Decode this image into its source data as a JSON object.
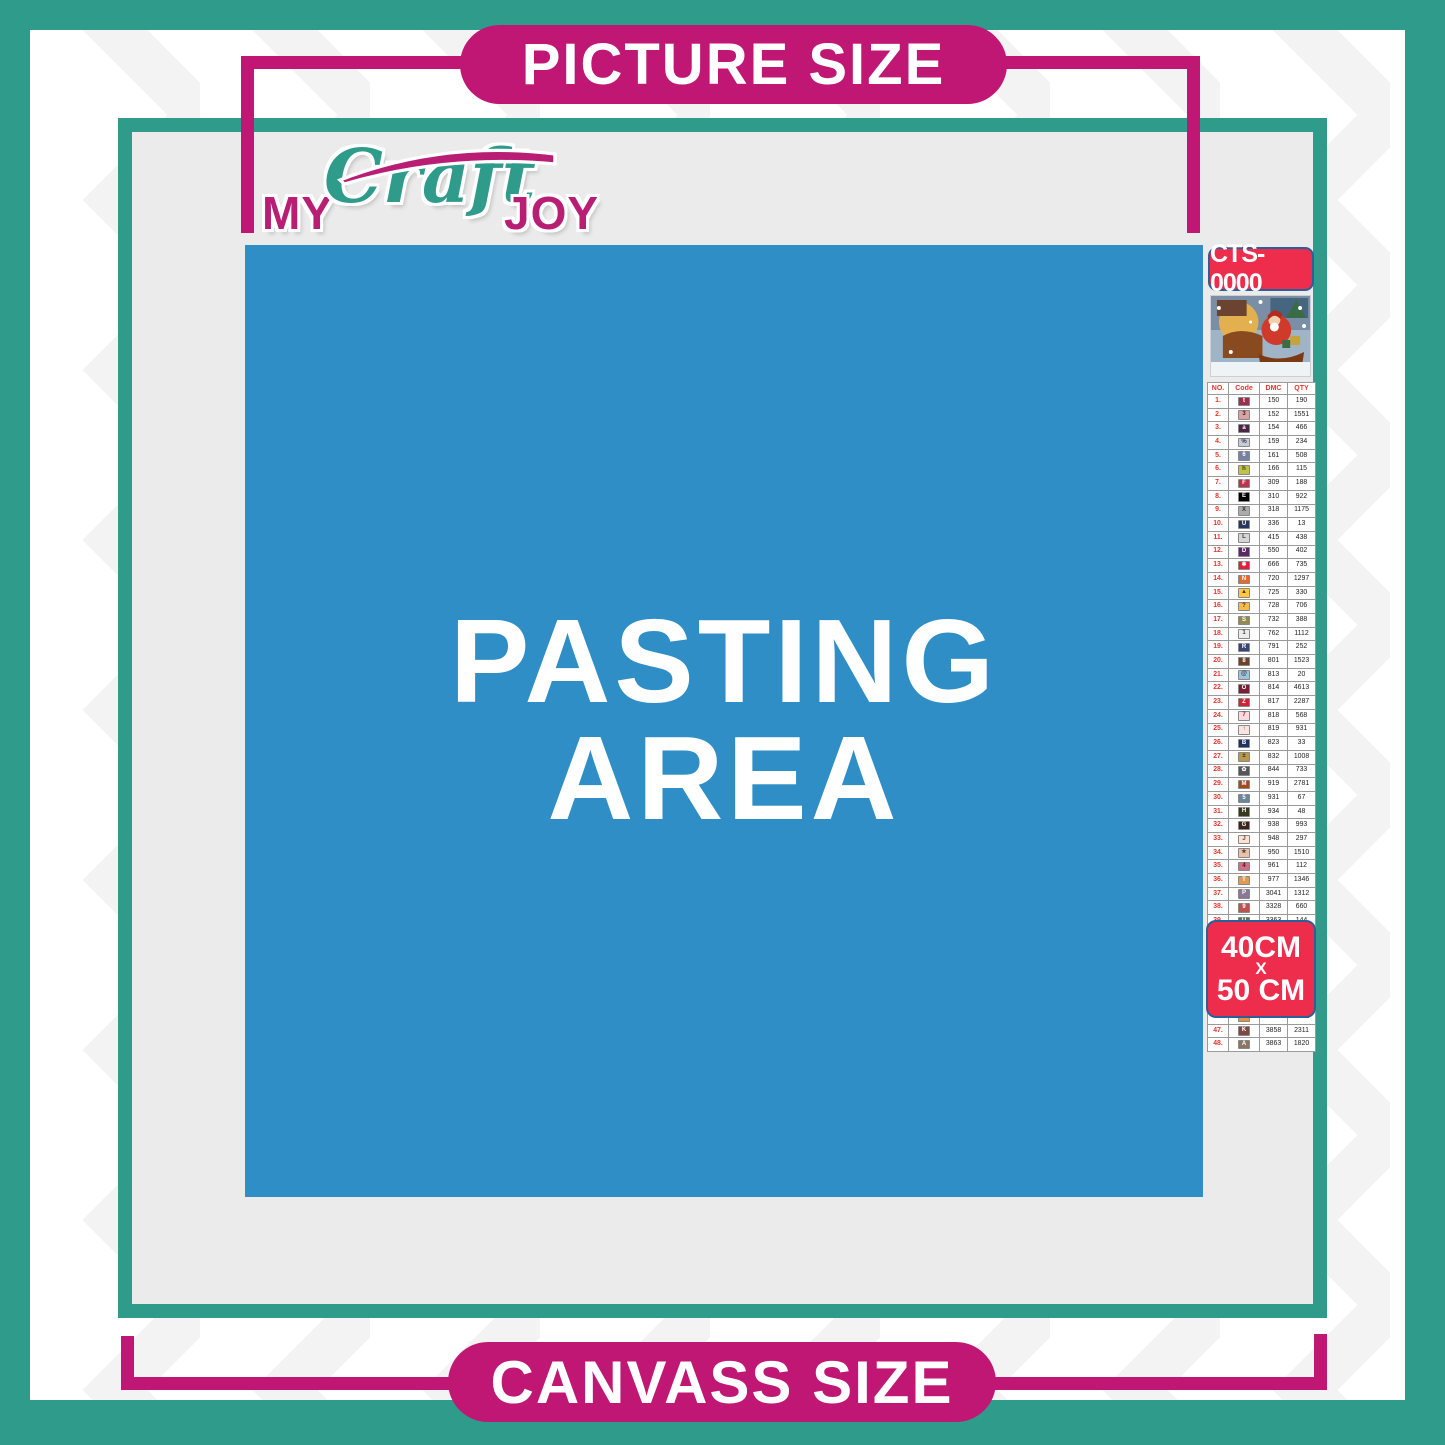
{
  "poster": {
    "top_label": "PICTURE SIZE",
    "bottom_label": "CANVASS SIZE",
    "pasting_area": {
      "line1": "PASTING",
      "line2": "AREA"
    },
    "logo": {
      "part1": "MY",
      "part2": "Craft",
      "part3": "JOY"
    }
  },
  "legend": {
    "sku": "CTS-0000",
    "thumbnail": "christmas-santa-sleigh-scene",
    "size_badge": {
      "line1": "40CM",
      "line2": "X",
      "line3": "50 CM"
    },
    "table": {
      "headers": [
        "NO.",
        "Code",
        "DMC",
        "QTY"
      ],
      "rows": [
        [
          "1.",
          "t",
          "150",
          "190",
          "#99314e",
          "#ffffff"
        ],
        [
          "2.",
          "3",
          "152",
          "1551",
          "#d8a3a2",
          "#3a2222"
        ],
        [
          "3.",
          "a",
          "154",
          "466",
          "#4a2644",
          "#ffffff"
        ],
        [
          "4.",
          "%",
          "159",
          "234",
          "#c7cad8",
          "#3a3a4a"
        ],
        [
          "5.",
          "6",
          "161",
          "508",
          "#7880a4",
          "#ffffff"
        ],
        [
          "6.",
          "h",
          "166",
          "115",
          "#c0c248",
          "#3a3a12"
        ],
        [
          "7.",
          "F",
          "309",
          "188",
          "#ba344c",
          "#ffffff"
        ],
        [
          "8.",
          "E",
          "310",
          "922",
          "#000000",
          "#ffffff"
        ],
        [
          "9.",
          "X",
          "318",
          "1175",
          "#ababab",
          "#333333"
        ],
        [
          "10.",
          "U",
          "336",
          "13",
          "#28365e",
          "#ffffff"
        ],
        [
          "11.",
          "L",
          "415",
          "438",
          "#d5d5d8",
          "#444444"
        ],
        [
          "12.",
          "D",
          "550",
          "402",
          "#5c2a66",
          "#ffffff"
        ],
        [
          "13.",
          "✱",
          "666",
          "735",
          "#e31c37",
          "#ffffff"
        ],
        [
          "14.",
          "N",
          "720",
          "1297",
          "#e7692e",
          "#ffffff"
        ],
        [
          "15.",
          "▲",
          "725",
          "330",
          "#ffc840",
          "#4a3a08"
        ],
        [
          "16.",
          "?",
          "728",
          "706",
          "#f4bb51",
          "#4a3a08"
        ],
        [
          "17.",
          "S",
          "732",
          "388",
          "#938b4f",
          "#ffffff"
        ],
        [
          "18.",
          "1",
          "762",
          "1112",
          "#ececec",
          "#444444"
        ],
        [
          "19.",
          "R",
          "791",
          "252",
          "#384577",
          "#ffffff"
        ],
        [
          "20.",
          "8",
          "801",
          "1523",
          "#6e4226",
          "#ffffff"
        ],
        [
          "21.",
          "@",
          "813",
          "20",
          "#a0c3dc",
          "#2a3c4c"
        ],
        [
          "22.",
          "O",
          "814",
          "4613",
          "#7b1d33",
          "#ffffff"
        ],
        [
          "23.",
          "Z",
          "817",
          "2287",
          "#cf2336",
          "#ffffff"
        ],
        [
          "24.",
          "7",
          "818",
          "568",
          "#fcd9df",
          "#6a3a44"
        ],
        [
          "25.",
          "↑",
          "819",
          "931",
          "#f9e4e2",
          "#6a4a4a"
        ],
        [
          "26.",
          "B",
          "823",
          "33",
          "#213363",
          "#ffffff"
        ],
        [
          "27.",
          "±",
          "832",
          "1008",
          "#b99a4d",
          "#3a2e0e"
        ],
        [
          "28.",
          "✿",
          "844",
          "733",
          "#54575a",
          "#ffffff"
        ],
        [
          "29.",
          "M",
          "919",
          "2781",
          "#a24a20",
          "#ffffff"
        ],
        [
          "30.",
          "5",
          "931",
          "67",
          "#6a859e",
          "#ffffff"
        ],
        [
          "31.",
          "H",
          "934",
          "48",
          "#36391f",
          "#ffffff"
        ],
        [
          "32.",
          "G",
          "938",
          "993",
          "#3b241a",
          "#ffffff"
        ],
        [
          "33.",
          "J",
          "948",
          "297",
          "#fbe2d2",
          "#6a4a3a"
        ],
        [
          "34.",
          "★",
          "950",
          "1510",
          "#e8c2a9",
          "#5a4232"
        ],
        [
          "35.",
          "4",
          "961",
          "112",
          "#d16f89",
          "#4a1626"
        ],
        [
          "36.",
          "T",
          "977",
          "1346",
          "#dc9c53",
          "#ffffff"
        ],
        [
          "37.",
          "P",
          "3041",
          "1312",
          "#8a7896",
          "#ffffff"
        ],
        [
          "38.",
          "9",
          "3328",
          "660",
          "#bd5350",
          "#ffffff"
        ],
        [
          "39.",
          "U",
          "3363",
          "144",
          "#60794f",
          "#ffffff"
        ],
        [
          "40.",
          "≡",
          "3371",
          "1680",
          "#241309",
          "#ffffff"
        ],
        [
          "41.",
          "Y",
          "3743",
          "1738",
          "#d6cfda",
          "#4a4452"
        ],
        [
          "42.",
          "∧",
          "3770",
          "40",
          "#fbeadd",
          "#6a5242"
        ],
        [
          "43.",
          "V",
          "3782",
          "617",
          "#d0bfa5",
          "#4a3c2a"
        ],
        [
          "44.",
          "2",
          "3819",
          "119",
          "#ccd04f",
          "#3a3e0e"
        ],
        [
          "45.",
          "✓",
          "3823",
          "107",
          "#fdf4d4",
          "#6a5e2a"
        ],
        [
          "46.",
          "C",
          "3853",
          "1332",
          "#ef8e3f",
          "#ffffff"
        ],
        [
          "47.",
          "K",
          "3858",
          "2311",
          "#7c4a43",
          "#ffffff"
        ],
        [
          "48.",
          "A",
          "3863",
          "1820",
          "#8c7662",
          "#ffffff"
        ]
      ]
    }
  },
  "colors": {
    "teal": "#2f9b8a",
    "magenta": "#c01774",
    "badge_red": "#ee2c4c",
    "badge_border_blue": "#2a6099",
    "pasting_blue": "#2e8ec5",
    "interior_gray": "#ebebeb"
  }
}
